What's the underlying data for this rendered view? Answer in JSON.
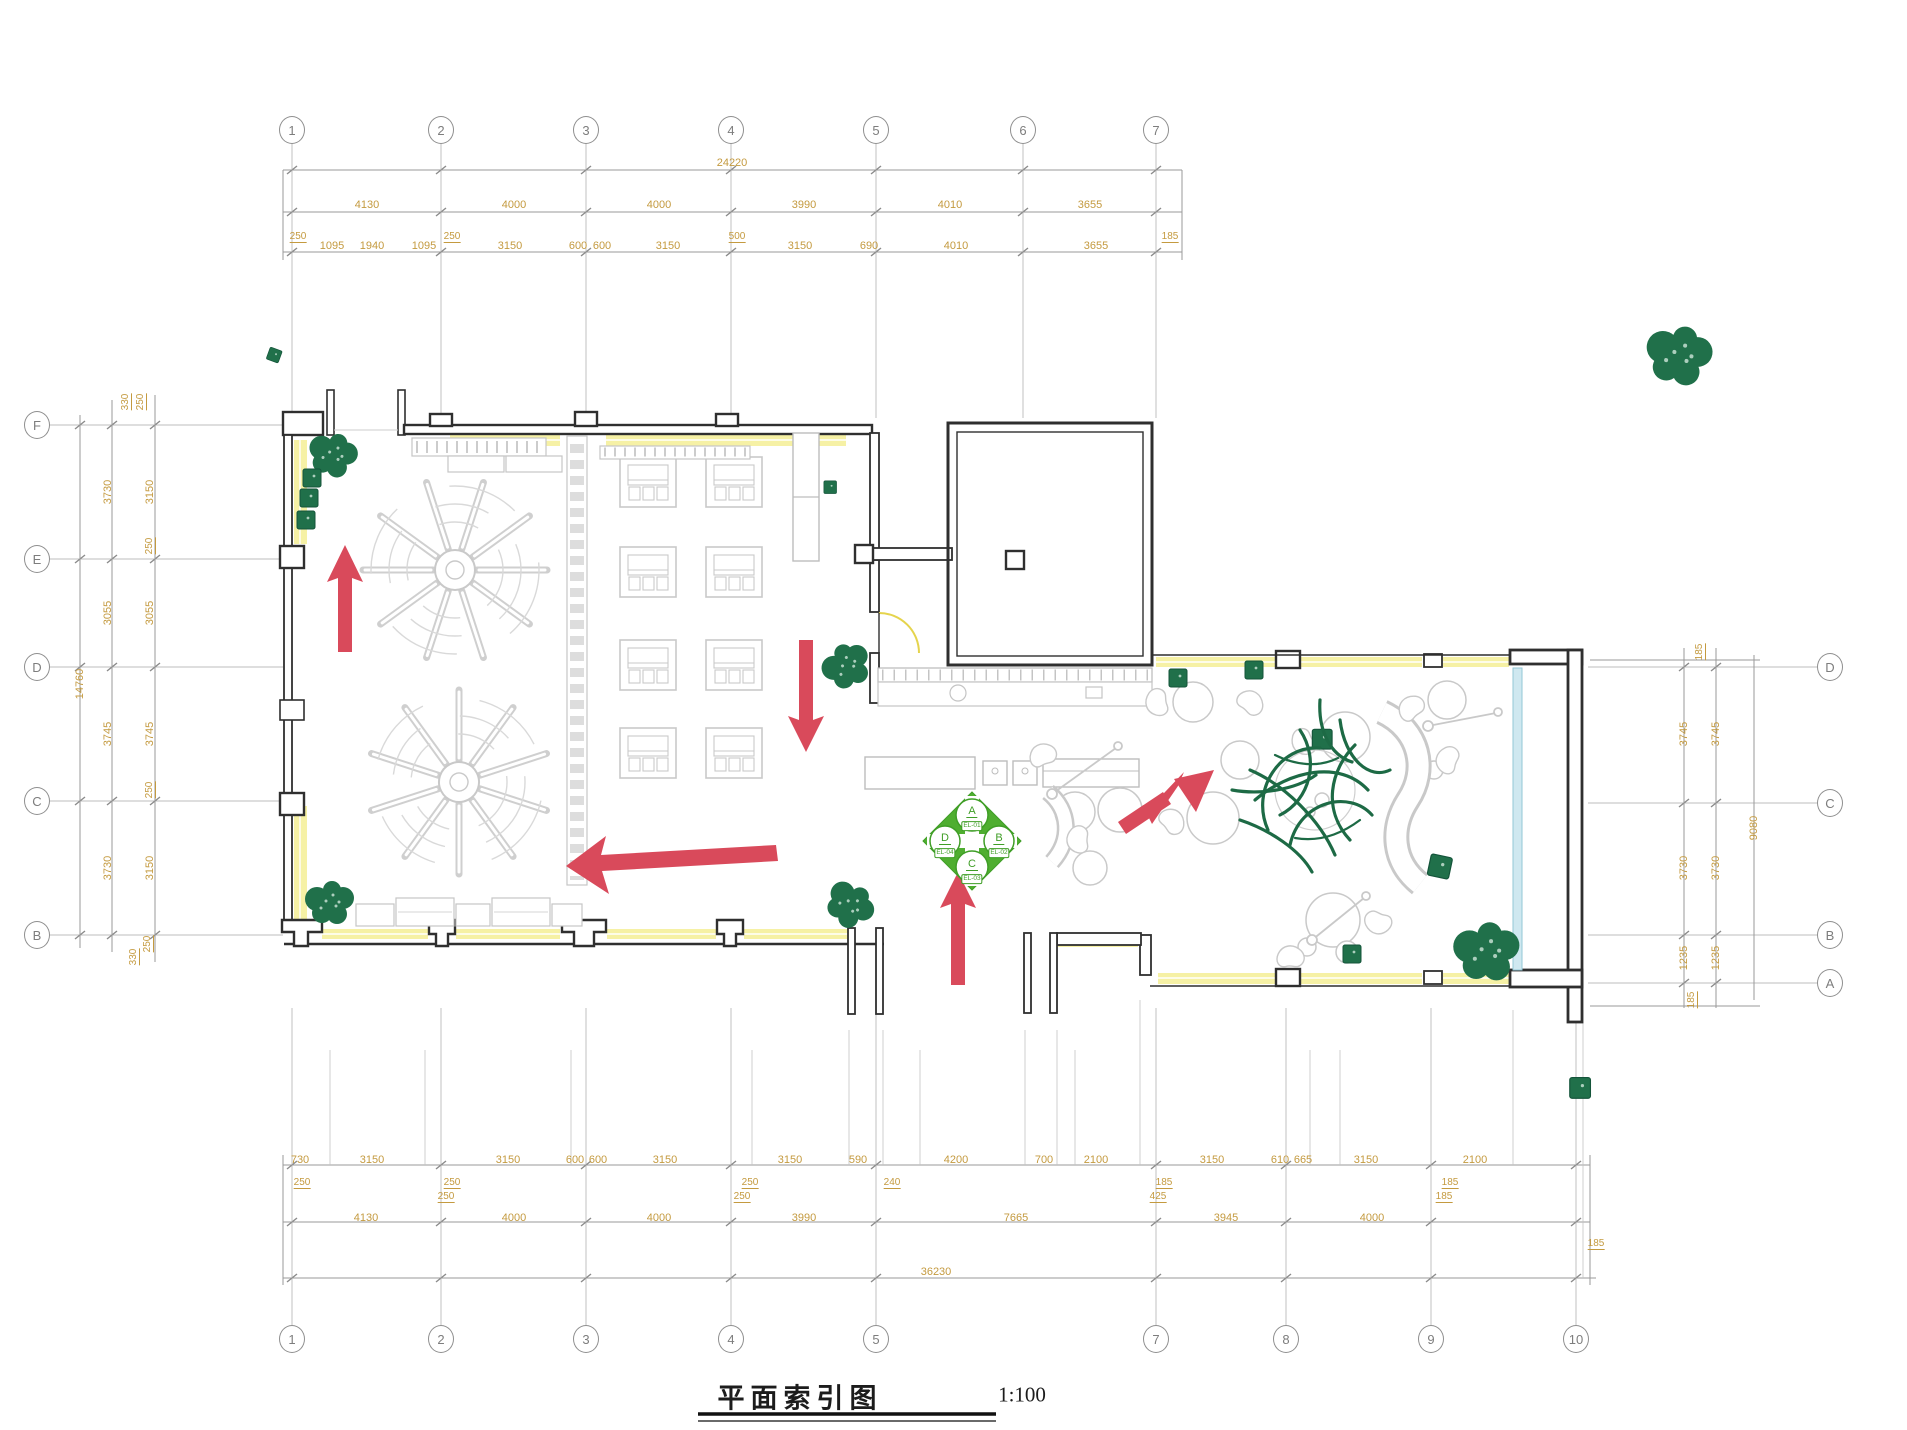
{
  "title_block": {
    "title": "平面索引图",
    "scale": "1:100"
  },
  "colors": {
    "dimension_text": "#c49a3f",
    "wall": "#2f2f2f",
    "grid_line": "#b9b9b9",
    "furniture": "#c9c9c9",
    "plant_green": "#20704a",
    "marker_green": "#4fae30",
    "arrow_red": "#d94a5b",
    "wall_band_yellow": "#f6f1a5",
    "glass_blue": "#cfe8f0"
  },
  "grid": {
    "top": [
      {
        "label": "1",
        "x": 292
      },
      {
        "label": "2",
        "x": 441
      },
      {
        "label": "3",
        "x": 586
      },
      {
        "label": "4",
        "x": 731
      },
      {
        "label": "5",
        "x": 876
      },
      {
        "label": "6",
        "x": 1023
      },
      {
        "label": "7",
        "x": 1156
      }
    ],
    "bottom": [
      {
        "label": "1",
        "x": 292
      },
      {
        "label": "2",
        "x": 441
      },
      {
        "label": "3",
        "x": 586
      },
      {
        "label": "4",
        "x": 731
      },
      {
        "label": "5",
        "x": 876
      },
      {
        "label": "7",
        "x": 1156
      },
      {
        "label": "8",
        "x": 1286
      },
      {
        "label": "9",
        "x": 1431
      },
      {
        "label": "10",
        "x": 1576
      }
    ],
    "left": [
      {
        "label": "F",
        "y": 425
      },
      {
        "label": "E",
        "y": 559
      },
      {
        "label": "D",
        "y": 667
      },
      {
        "label": "C",
        "y": 801
      },
      {
        "label": "B",
        "y": 935
      }
    ],
    "right": [
      {
        "label": "D",
        "y": 667
      },
      {
        "label": "C",
        "y": 803
      },
      {
        "label": "B",
        "y": 935
      },
      {
        "label": "A",
        "y": 983
      }
    ]
  },
  "dim_labels": [
    {
      "t": "24220",
      "x": 732,
      "y": 163
    },
    {
      "t": "4130",
      "x": 367,
      "y": 205
    },
    {
      "t": "4000",
      "x": 514,
      "y": 205
    },
    {
      "t": "4000",
      "x": 659,
      "y": 205
    },
    {
      "t": "3990",
      "x": 804,
      "y": 205
    },
    {
      "t": "4010",
      "x": 950,
      "y": 205
    },
    {
      "t": "3655",
      "x": 1090,
      "y": 205
    },
    {
      "t": "250",
      "x": 298,
      "y": 237,
      "s": 1
    },
    {
      "t": "1095",
      "x": 332,
      "y": 246
    },
    {
      "t": "1940",
      "x": 372,
      "y": 246
    },
    {
      "t": "1095",
      "x": 424,
      "y": 246
    },
    {
      "t": "250",
      "x": 452,
      "y": 237,
      "s": 1
    },
    {
      "t": "3150",
      "x": 510,
      "y": 246
    },
    {
      "t": "600",
      "x": 578,
      "y": 246
    },
    {
      "t": "600",
      "x": 602,
      "y": 246
    },
    {
      "t": "3150",
      "x": 668,
      "y": 246
    },
    {
      "t": "500",
      "x": 737,
      "y": 237,
      "s": 1
    },
    {
      "t": "3150",
      "x": 800,
      "y": 246
    },
    {
      "t": "690",
      "x": 869,
      "y": 246
    },
    {
      "t": "4010",
      "x": 956,
      "y": 246
    },
    {
      "t": "3655",
      "x": 1096,
      "y": 246
    },
    {
      "t": "185",
      "x": 1170,
      "y": 237,
      "s": 1
    },
    {
      "t": "14760",
      "x": 80,
      "y": 684,
      "r": 1
    },
    {
      "t": "3730",
      "x": 108,
      "y": 492,
      "r": 1
    },
    {
      "t": "3055",
      "x": 108,
      "y": 613,
      "r": 1
    },
    {
      "t": "3745",
      "x": 108,
      "y": 734,
      "r": 1
    },
    {
      "t": "3730",
      "x": 108,
      "y": 868,
      "r": 1
    },
    {
      "t": "3150",
      "x": 150,
      "y": 492,
      "r": 1
    },
    {
      "t": "3055",
      "x": 150,
      "y": 613,
      "r": 1
    },
    {
      "t": "3745",
      "x": 150,
      "y": 734,
      "r": 1
    },
    {
      "t": "3150",
      "x": 150,
      "y": 868,
      "r": 1
    },
    {
      "t": "330",
      "x": 126,
      "y": 402,
      "r": 1,
      "s": 1
    },
    {
      "t": "250",
      "x": 141,
      "y": 402,
      "r": 1,
      "s": 1
    },
    {
      "t": "250",
      "x": 150,
      "y": 546,
      "r": 1,
      "s": 1
    },
    {
      "t": "250",
      "x": 150,
      "y": 790,
      "r": 1,
      "s": 1
    },
    {
      "t": "250",
      "x": 148,
      "y": 944,
      "r": 1,
      "s": 1
    },
    {
      "t": "330",
      "x": 134,
      "y": 957,
      "r": 1,
      "s": 1
    },
    {
      "t": "3745",
      "x": 1684,
      "y": 734,
      "r": 1
    },
    {
      "t": "3730",
      "x": 1684,
      "y": 868,
      "r": 1
    },
    {
      "t": "1235",
      "x": 1684,
      "y": 958,
      "r": 1
    },
    {
      "t": "3745",
      "x": 1716,
      "y": 734,
      "r": 1
    },
    {
      "t": "3730",
      "x": 1716,
      "y": 868,
      "r": 1
    },
    {
      "t": "1235",
      "x": 1716,
      "y": 958,
      "r": 1
    },
    {
      "t": "9080",
      "x": 1754,
      "y": 828,
      "r": 1
    },
    {
      "t": "185",
      "x": 1700,
      "y": 652,
      "r": 1,
      "s": 1
    },
    {
      "t": "185",
      "x": 1692,
      "y": 1000,
      "r": 1,
      "s": 1
    },
    {
      "t": "730",
      "x": 300,
      "y": 1160
    },
    {
      "t": "3150",
      "x": 372,
      "y": 1160
    },
    {
      "t": "3150",
      "x": 508,
      "y": 1160
    },
    {
      "t": "600",
      "x": 575,
      "y": 1160
    },
    {
      "t": "600",
      "x": 598,
      "y": 1160
    },
    {
      "t": "3150",
      "x": 665,
      "y": 1160
    },
    {
      "t": "3150",
      "x": 790,
      "y": 1160
    },
    {
      "t": "590",
      "x": 858,
      "y": 1160
    },
    {
      "t": "4200",
      "x": 956,
      "y": 1160
    },
    {
      "t": "700",
      "x": 1044,
      "y": 1160
    },
    {
      "t": "2100",
      "x": 1096,
      "y": 1160
    },
    {
      "t": "3150",
      "x": 1212,
      "y": 1160
    },
    {
      "t": "610",
      "x": 1280,
      "y": 1160
    },
    {
      "t": "665",
      "x": 1303,
      "y": 1160
    },
    {
      "t": "3150",
      "x": 1366,
      "y": 1160
    },
    {
      "t": "2100",
      "x": 1475,
      "y": 1160
    },
    {
      "t": "250",
      "x": 302,
      "y": 1183,
      "s": 1
    },
    {
      "t": "250",
      "x": 452,
      "y": 1183,
      "s": 1
    },
    {
      "t": "250",
      "x": 446,
      "y": 1197,
      "s": 1
    },
    {
      "t": "250",
      "x": 750,
      "y": 1183,
      "s": 1
    },
    {
      "t": "250",
      "x": 742,
      "y": 1197,
      "s": 1
    },
    {
      "t": "240",
      "x": 892,
      "y": 1183,
      "s": 1
    },
    {
      "t": "185",
      "x": 1164,
      "y": 1183,
      "s": 1
    },
    {
      "t": "425",
      "x": 1158,
      "y": 1197,
      "s": 1
    },
    {
      "t": "185",
      "x": 1450,
      "y": 1183,
      "s": 1
    },
    {
      "t": "185",
      "x": 1444,
      "y": 1197,
      "s": 1
    },
    {
      "t": "185",
      "x": 1596,
      "y": 1244,
      "s": 1
    },
    {
      "t": "4130",
      "x": 366,
      "y": 1218
    },
    {
      "t": "4000",
      "x": 514,
      "y": 1218
    },
    {
      "t": "4000",
      "x": 659,
      "y": 1218
    },
    {
      "t": "3990",
      "x": 804,
      "y": 1218
    },
    {
      "t": "7665",
      "x": 1016,
      "y": 1218
    },
    {
      "t": "3945",
      "x": 1226,
      "y": 1218
    },
    {
      "t": "4000",
      "x": 1372,
      "y": 1218
    },
    {
      "t": "36230",
      "x": 936,
      "y": 1272
    }
  ],
  "elevation_marker": {
    "letters": [
      {
        "t": "A",
        "x": 972,
        "y": 812
      },
      {
        "t": "B",
        "x": 999,
        "y": 839
      },
      {
        "t": "C",
        "x": 972,
        "y": 865
      },
      {
        "t": "D",
        "x": 945,
        "y": 839
      }
    ],
    "tags": [
      {
        "t": "EL-01",
        "x": 972,
        "y": 826
      },
      {
        "t": "EL-02",
        "x": 999,
        "y": 853
      },
      {
        "t": "EL-03",
        "x": 972,
        "y": 879
      },
      {
        "t": "EL-04",
        "x": 945,
        "y": 853
      }
    ]
  },
  "flow_arrows": [
    {
      "name": "flow-arrow-up-left-hall",
      "direction": "up"
    },
    {
      "name": "flow-arrow-down-center",
      "direction": "down"
    },
    {
      "name": "flow-arrow-left-long",
      "direction": "left"
    },
    {
      "name": "flow-arrow-up-entrance",
      "direction": "up"
    },
    {
      "name": "flow-arrow-northeast-lounge",
      "direction": "up-right"
    }
  ]
}
